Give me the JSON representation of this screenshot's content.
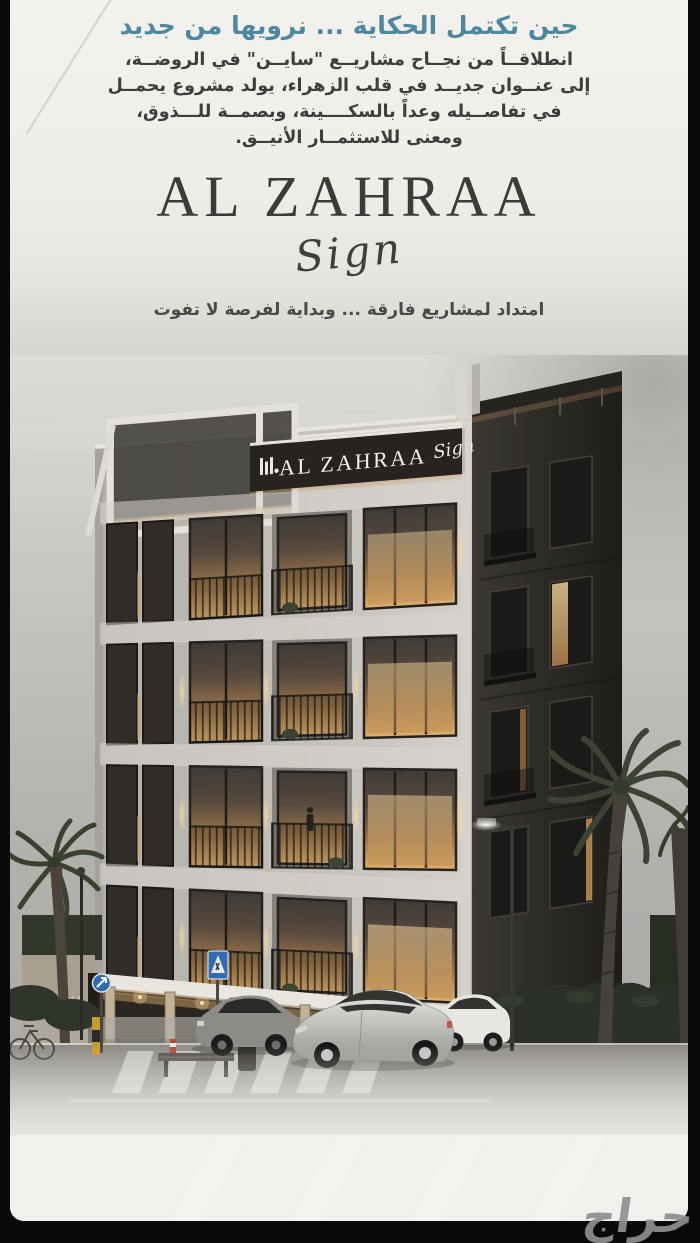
{
  "poster": {
    "headline": "حين تكتمل الحكاية ... نرويها من جديد",
    "paragraph_lines": [
      "انطلاقــاً من نجــاح مشاريــع \"سايــن\" في الروضــة،",
      "إلى عنــوان جديــد في قلب الزهراء، يولد مشروع يحمــل",
      "في تفاصــيله وعداً بالسكــــينة، وبصمــة للـــذوق،",
      "ومعنى للاستثمــار الأنيــق."
    ],
    "brand": {
      "name": "AL ZAHRAA",
      "script": "Sign"
    },
    "tagline": "امتداد لمشاريع فارقة ... وبداية لفرصة لا تفوت"
  },
  "building": {
    "facade_sign": {
      "name": "AL ZAHRAA",
      "script": "Sign"
    },
    "entrance_wall_sign": {
      "name": "AL ZAHRAA",
      "script": "Sign"
    }
  },
  "watermark": {
    "logo_text": "حراج"
  },
  "icons": {
    "facade_logo": "three-bars-building-mark"
  },
  "colors": {
    "headline_teal": "#4e87a0",
    "body_text": "#3e3e3e",
    "brand_dark": "#3a3b3b",
    "poster_background": "#f0efea",
    "sky_grey": "#b0aeab",
    "frame_black": "#0a0a0a",
    "window_glow": "#e3b269"
  }
}
